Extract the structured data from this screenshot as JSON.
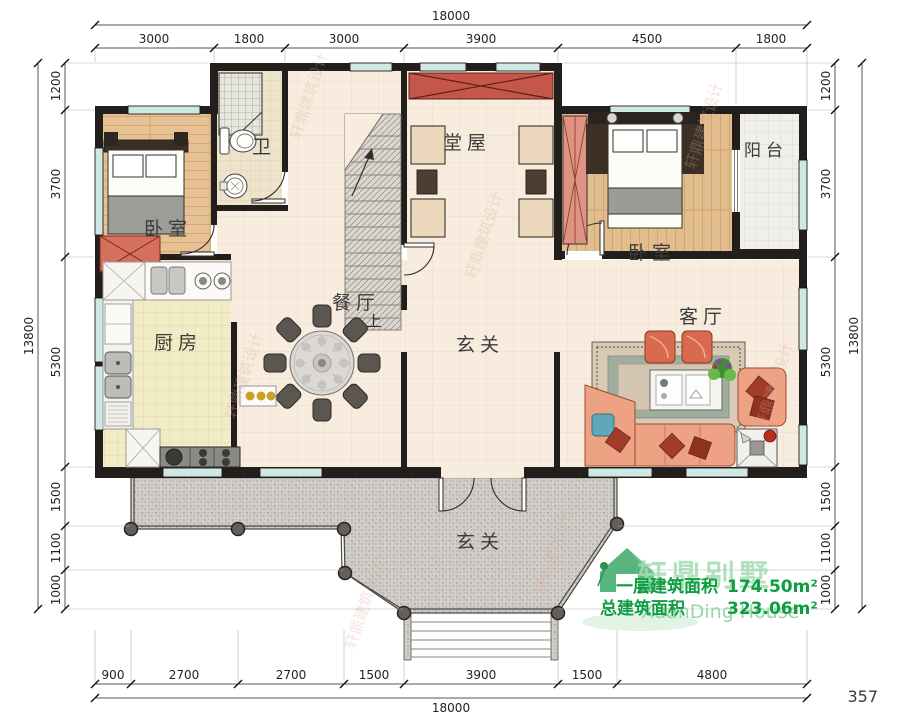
{
  "dimensions": {
    "top": {
      "total": "18000",
      "segments": [
        "3000",
        "1800",
        "3000",
        "3900",
        "4500",
        "1800"
      ]
    },
    "bottom": {
      "total": "18000",
      "segments": [
        "900",
        "2700",
        "2700",
        "1500",
        "3900",
        "1500",
        "4800"
      ]
    },
    "left": {
      "total": "13800",
      "segments": [
        "1200",
        "3700",
        "5300",
        "1500",
        "1100",
        "1000"
      ]
    },
    "right": {
      "total": "13800",
      "segments": [
        "1200",
        "3700",
        "5300",
        "1500",
        "1100",
        "1000"
      ]
    }
  },
  "rooms": {
    "bedroom_left": "卧室",
    "bath": "卫",
    "tangwu": "堂屋",
    "bedroom_right": "卧室",
    "balcony": "阳台",
    "kitchen": "厨房",
    "dining": "餐厅",
    "foyer": "玄关",
    "living": "客厅",
    "porch": "玄关",
    "stair_up": "上"
  },
  "annotations": {
    "area_line1_label": "一层建筑面积",
    "area_line1_value": "174.50m²",
    "area_line2_label": "总建筑面积",
    "area_line2_value": "323.06m²",
    "page_number": "357"
  },
  "brand": {
    "cn": "轩鼎别墅",
    "en": "XuanDing House",
    "watermark": "轩鼎建筑设计"
  },
  "colors": {
    "wall": "#211e1b",
    "window": "#cfe8e4",
    "floor_main": "#f8ecdf",
    "floor_wood": "#e4bf92",
    "floor_kitchen": "#f2ecc6",
    "accent_red": "#c4574a",
    "sofa": "#eda284",
    "green_text": "#0f9d41",
    "terrace": "#d1cdc8"
  }
}
